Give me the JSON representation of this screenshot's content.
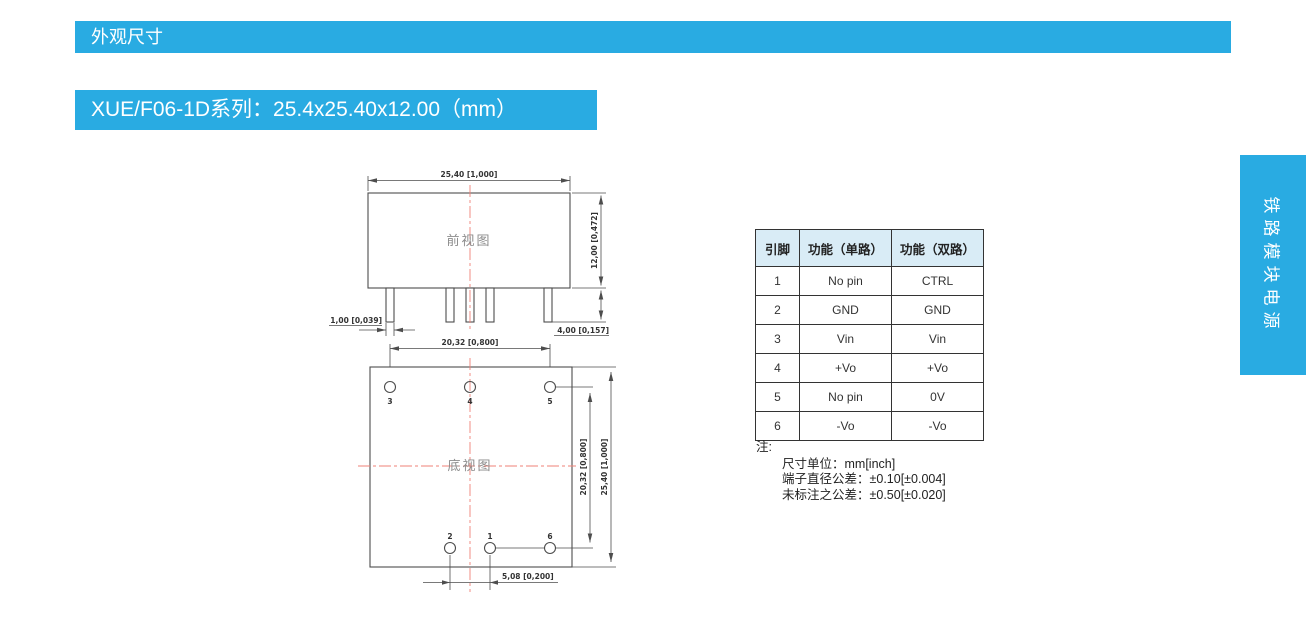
{
  "page": {
    "banner": "外观尺寸",
    "title": "XUE/F06-1D系列：25.4x25.40x12.00（mm）",
    "side_tab": "铁路模块电源"
  },
  "drawing": {
    "front_view": {
      "label": "前视图",
      "dims": {
        "width": "25,40 [1,000]",
        "height": "12,00 [0,472]",
        "pin_width": "1,00 [0,039]",
        "pin_length": "4,00 [0,157]"
      }
    },
    "bottom_view": {
      "label": "底视图",
      "dims": {
        "pin_span_x": "20,32 [0,800]",
        "pin_span_y": "20,32 [0,800]",
        "body_height": "25,40 [1,000]",
        "pin_offset": "5,08 [0,200]"
      },
      "pin_numbers_top": [
        "3",
        "4",
        "5"
      ],
      "pin_numbers_bottom": [
        "2",
        "1",
        "6"
      ]
    }
  },
  "pin_table": {
    "headers": [
      "引脚",
      "功能（单路）",
      "功能（双路）"
    ],
    "rows": [
      {
        "pin": "1",
        "single": "No pin",
        "dual": "CTRL"
      },
      {
        "pin": "2",
        "single": "GND",
        "dual": "GND"
      },
      {
        "pin": "3",
        "single": "Vin",
        "dual": "Vin"
      },
      {
        "pin": "4",
        "single": "+Vo",
        "dual": "+Vo"
      },
      {
        "pin": "5",
        "single": "No pin",
        "dual": "0V"
      },
      {
        "pin": "6",
        "single": "-Vo",
        "dual": "-Vo"
      }
    ]
  },
  "notes": {
    "label": "注:",
    "lines": [
      "尺寸单位：mm[inch]",
      "端子直径公差：±0.10[±0.004]",
      "未标注之公差：±0.50[±0.020]"
    ]
  },
  "colors": {
    "accent": "#29abe2",
    "accent_text": "#ffffff",
    "table_header_bg": "#d9ecf6",
    "table_border": "#333333",
    "drawing_line": "#4d4d4d",
    "centerline_red": "#ef8277",
    "note_text": "#222222"
  }
}
